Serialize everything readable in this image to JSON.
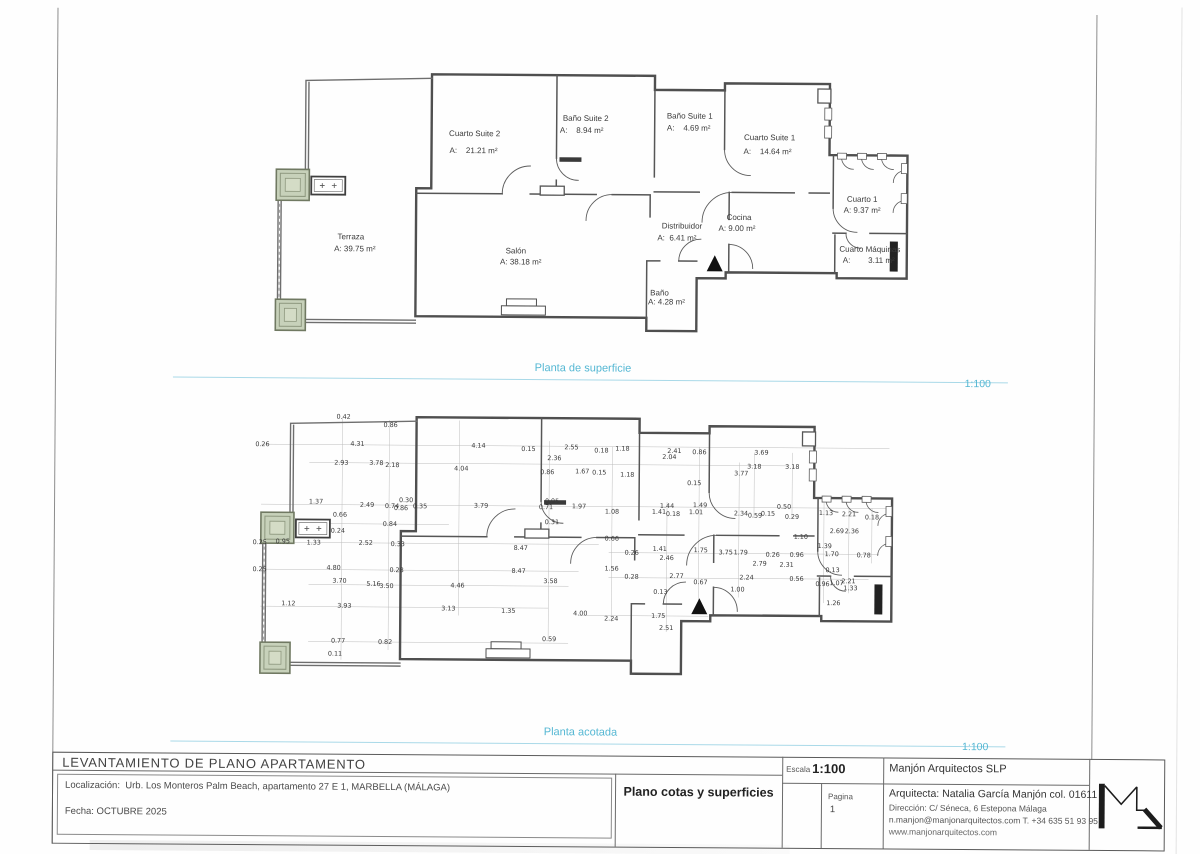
{
  "sections": {
    "surface": {
      "label": "Planta de superficie",
      "scale": "1:100"
    },
    "dimensioned": {
      "label": "Planta acotada",
      "scale": "1:100"
    }
  },
  "rooms": [
    {
      "name": "Terraza",
      "area": "A: 39.75 m²",
      "nx": 87,
      "ny": 180,
      "ax": 91,
      "ay": 192
    },
    {
      "name": "Cuarto Suite 2",
      "area": "A:    21.21 m²",
      "nx": 210,
      "ny": 76,
      "ax": 209,
      "ay": 93
    },
    {
      "name": "Baño Suite 2",
      "area": "A:    8.94 m²",
      "nx": 321,
      "ny": 60,
      "ax": 317,
      "ay": 72
    },
    {
      "name": "Baño Suite 1",
      "area": "A:    4.69 m²",
      "nx": 425,
      "ny": 57,
      "ax": 424,
      "ay": 69
    },
    {
      "name": "Cuarto Suite 1",
      "area": "A:    14.64 m²",
      "nx": 505,
      "ny": 78,
      "ax": 503,
      "ay": 92
    },
    {
      "name": "Cuarto 1",
      "area": "A: 9.37 m²",
      "nx": 598,
      "ny": 139,
      "ax": 598,
      "ay": 150
    },
    {
      "name": "Cocina",
      "area": "A: 9.00 m²",
      "nx": 475,
      "ny": 158,
      "ax": 473,
      "ay": 169
    },
    {
      "name": "Distribuidor",
      "area": "A:  6.41 m²",
      "nx": 418,
      "ny": 167,
      "ax": 413,
      "ay": 179
    },
    {
      "name": "Salón",
      "area": "A: 38.18 m²",
      "nx": 252,
      "ny": 193,
      "ax": 257,
      "ay": 204
    },
    {
      "name": "Baño",
      "area": "A: 4.28 m²",
      "nx": 396,
      "ny": 234,
      "ax": 403,
      "ay": 243
    },
    {
      "name": "Cuarto Máquinas",
      "area": "A:        3.11 m²",
      "nx": 606,
      "ny": 189,
      "ax": 605,
      "ay": 200
    }
  ],
  "dims": [
    [
      "0.42",
      94,
      17
    ],
    [
      "0.86",
      141,
      25
    ],
    [
      "0.26",
      13,
      45
    ],
    [
      "4.31",
      108,
      44
    ],
    [
      "4.14",
      229,
      45
    ],
    [
      "0.15",
      279,
      48
    ],
    [
      "2.55",
      322,
      46
    ],
    [
      "2.93",
      92,
      63
    ],
    [
      "3.78",
      127,
      63
    ],
    [
      "2.18",
      143,
      65
    ],
    [
      "4.04",
      212,
      68
    ],
    [
      "2.36",
      305,
      57
    ],
    [
      "0.86",
      298,
      71
    ],
    [
      "0.18",
      352,
      49
    ],
    [
      "1.18",
      373,
      47
    ],
    [
      "2.41",
      425,
      49
    ],
    [
      "2.04",
      420,
      55
    ],
    [
      "0.86",
      450,
      50
    ],
    [
      "3.69",
      512,
      50
    ],
    [
      "3.18",
      505,
      64
    ],
    [
      "3.18",
      543,
      64
    ],
    [
      "3.77",
      492,
      71
    ],
    [
      "1.67",
      333,
      70
    ],
    [
      "0.15",
      350,
      71
    ],
    [
      "1.18",
      378,
      73
    ],
    [
      "0.15",
      445,
      81
    ],
    [
      "1.37",
      67,
      102
    ],
    [
      "2.49",
      118,
      105
    ],
    [
      "0.74",
      143,
      106
    ],
    [
      "0.86",
      152,
      108
    ],
    [
      "0.30",
      157,
      100
    ],
    [
      "0.35",
      171,
      106
    ],
    [
      "3.79",
      232,
      105
    ],
    [
      "0.71",
      297,
      106
    ],
    [
      "0.95",
      303,
      100
    ],
    [
      "1.97",
      330,
      105
    ],
    [
      "0.31",
      303,
      121
    ],
    [
      "0.66",
      91,
      115
    ],
    [
      "0.84",
      141,
      124
    ],
    [
      "0.24",
      89,
      131
    ],
    [
      "1.08",
      363,
      110
    ],
    [
      "1.41",
      410,
      110
    ],
    [
      "0.18",
      424,
      112
    ],
    [
      "1.44",
      418,
      104
    ],
    [
      "1.49",
      451,
      103
    ],
    [
      "1.01",
      447,
      110
    ],
    [
      "2.34",
      492,
      111
    ],
    [
      "0.59",
      506,
      113
    ],
    [
      "0.15",
      519,
      111
    ],
    [
      "0.50",
      535,
      104
    ],
    [
      "0.29",
      543,
      114
    ],
    [
      "1.13",
      577,
      110
    ],
    [
      "2.21",
      600,
      111
    ],
    [
      "0.18",
      623,
      114
    ],
    [
      "0.25",
      11,
      143
    ],
    [
      "0.95",
      34,
      142
    ],
    [
      "1.33",
      65,
      143
    ],
    [
      "2.52",
      117,
      143
    ],
    [
      "0.33",
      149,
      144
    ],
    [
      "8.47",
      272,
      147
    ],
    [
      "0.66",
      363,
      137
    ],
    [
      "2.69",
      588,
      128
    ],
    [
      "2.36",
      603,
      128
    ],
    [
      "1.10",
      552,
      134
    ],
    [
      "1.39",
      576,
      143
    ],
    [
      "1.70",
      583,
      151
    ],
    [
      "0.78",
      615,
      152
    ],
    [
      "0.26",
      383,
      151
    ],
    [
      "1.41",
      411,
      147
    ],
    [
      "1.75",
      452,
      148
    ],
    [
      "3.75",
      477,
      150
    ],
    [
      "1.79",
      492,
      150
    ],
    [
      "0.26",
      524,
      152
    ],
    [
      "0.96",
      548,
      152
    ],
    [
      "2.46",
      418,
      156
    ],
    [
      "0.25",
      11,
      170
    ],
    [
      "4.80",
      85,
      168
    ],
    [
      "0.28",
      148,
      170
    ],
    [
      "8.47",
      270,
      170
    ],
    [
      "1.56",
      363,
      167
    ],
    [
      "2.79",
      511,
      161
    ],
    [
      "2.31",
      538,
      162
    ],
    [
      "0.13",
      584,
      167
    ],
    [
      "3.70",
      91,
      181
    ],
    [
      "5.16",
      125,
      184
    ],
    [
      "3.50",
      138,
      186
    ],
    [
      "4.46",
      209,
      185
    ],
    [
      "3.58",
      302,
      180
    ],
    [
      "0.28",
      383,
      175
    ],
    [
      "2.77",
      428,
      174
    ],
    [
      "0.67",
      452,
      180
    ],
    [
      "2.24",
      498,
      175
    ],
    [
      "0.56",
      548,
      176
    ],
    [
      "1.07",
      588,
      180
    ],
    [
      "2.21",
      600,
      178
    ],
    [
      "1.33",
      602,
      185
    ],
    [
      "0.96",
      574,
      181
    ],
    [
      "1.00",
      489,
      187
    ],
    [
      "0.13",
      412,
      190
    ],
    [
      "1.12",
      40,
      204
    ],
    [
      "3.93",
      96,
      206
    ],
    [
      "3.13",
      200,
      208
    ],
    [
      "1.35",
      260,
      210
    ],
    [
      "4.00",
      332,
      212
    ],
    [
      "2.24",
      363,
      217
    ],
    [
      "1.75",
      410,
      214
    ],
    [
      "2.51",
      418,
      226
    ],
    [
      "1.26",
      585,
      200
    ],
    [
      "0.77",
      90,
      241
    ],
    [
      "0.82",
      137,
      242
    ],
    [
      "0.59",
      301,
      238
    ],
    [
      "0.11",
      87,
      254
    ]
  ],
  "titleblock": {
    "title": "LEVANTAMIENTO DE PLANO APARTAMENTO",
    "location": "Localización:  Urb. Los Monteros Palm Beach, apartamento 27 E 1, MARBELLA (MÁLAGA)",
    "date": "Fecha: OCTUBRE 2025",
    "drawing_title": "Plano cotas y superficies",
    "scale_label": "Escala",
    "scale": "1:100",
    "page_label": "Pagina",
    "page_number": "1",
    "firm": "Manjón Arquitectos SLP",
    "architect": "Arquitecta: Natalia García Manjón col. 01611",
    "address": "Dirección: C/ Séneca, 6 Estepona Málaga",
    "contact": "n.manjon@manjonarquitectos.com T. +34 635 51 93 95",
    "web": "www.manjonarquitectos.com"
  },
  "colors": {
    "accent": "#54b7d3",
    "rule": "#a9d9e8",
    "planter": "#c7d1ba",
    "wall": "#4f4f4f"
  }
}
